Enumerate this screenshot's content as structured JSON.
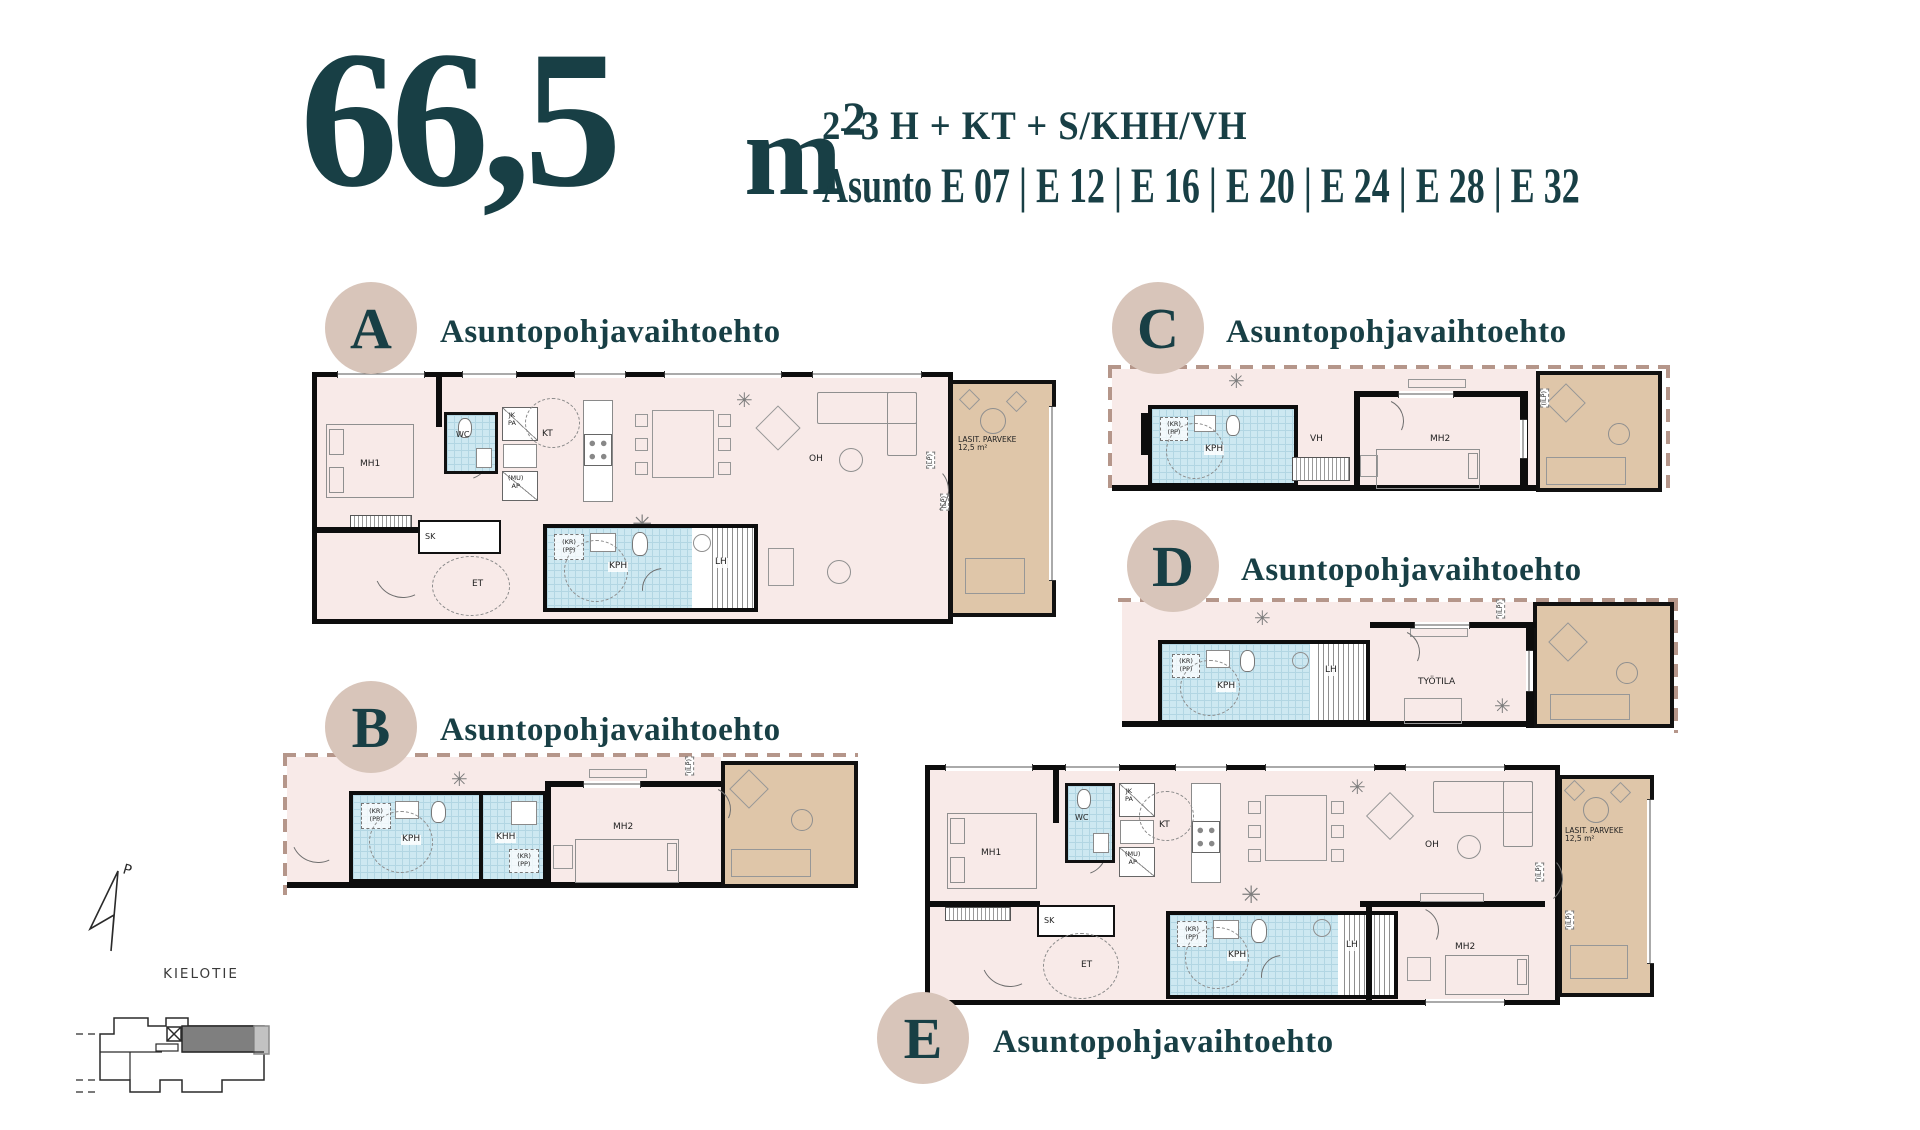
{
  "header": {
    "area": "66,5",
    "unit": "m",
    "unit_sup": "2",
    "type_line": "2–3 H + KT + S/KHH/VH",
    "apartments_line": "Asunto E 07 | E 12 | E 16 | E 20 | E 24 | E 28 | E 32"
  },
  "variant_label": "Asuntopohjavaihtoehto",
  "plans": [
    {
      "letter": "A"
    },
    {
      "letter": "B"
    },
    {
      "letter": "C"
    },
    {
      "letter": "D"
    },
    {
      "letter": "E"
    }
  ],
  "labels": {
    "mh1": "MH1",
    "mh2": "MH2",
    "wc": "WC",
    "kt": "KT",
    "oh": "OH",
    "et": "ET",
    "sk": "SK",
    "kph": "KPH",
    "lh": "LH",
    "khh": "KHH",
    "vh": "VH",
    "tyotila": "TYÖTILA",
    "jk": "JK",
    "pa": "PA",
    "mu": "(MU)",
    "ap": "AP",
    "kr": "(KR)",
    "pp": "(PP)",
    "ilp": "(ILP)",
    "lp": "(LP)",
    "balcony": "LASIT. PARVEKE",
    "balcony_area": "12,5 m²"
  },
  "site": {
    "street": "KIELOTIE",
    "north_label": "P"
  },
  "colors": {
    "teal": "#183F45",
    "badge_bg": "#D8C5BA",
    "floor_pink": "#F8EAE8",
    "bath_blue": "#CDE8F1",
    "balcony_tan": "#DFC6A9",
    "dash_brown": "#B5968A",
    "wall_black": "#0D0D0D"
  }
}
